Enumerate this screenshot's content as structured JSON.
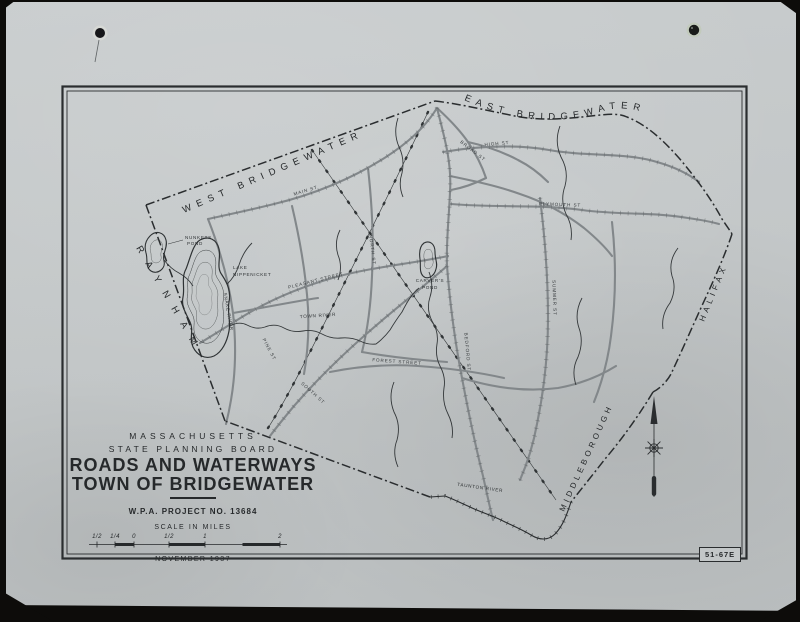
{
  "photo": {
    "plate_number": "51-67E"
  },
  "title_block": {
    "state": "MASSACHUSETTS",
    "agency": "STATE PLANNING BOARD",
    "title_line1": "ROADS AND WATERWAYS",
    "title_line2": "TOWN OF BRIDGEWATER",
    "project": "W.P.A. PROJECT NO. 13684",
    "scale_label": "SCALE IN MILES",
    "date": "NOVEMBER 1937"
  },
  "scale_bar": {
    "labels": [
      "1/2",
      "1/4",
      "0",
      "1/2",
      "1",
      "2"
    ]
  },
  "neighbors": {
    "west": "WEST BRIDGEWATER",
    "east": "EAST BRIDGEWATER",
    "southwest": "RAYNHAM",
    "northeast": "HALIFAX",
    "southeast": "MIDDLEBOROUGH"
  },
  "water_labels": {
    "nunkets_line1": "NUNKETS",
    "nunkets_line2": "POND",
    "nippenicket_line1": "LAKE",
    "nippenicket_line2": "NIPPENICKET",
    "carvers_line1": "CARVER'S",
    "carvers_line2": "POND",
    "town_river": "TOWN RIVER",
    "taunton_river": "TAUNTON RIVER",
    "snake_river": "SNAKE RIVER"
  },
  "street_labels": [
    {
      "text": "MAIN ST"
    },
    {
      "text": "HIGH ST"
    },
    {
      "text": "BROAD ST"
    },
    {
      "text": "PLYMOUTH ST"
    },
    {
      "text": "PLEASANT STREET"
    },
    {
      "text": "NORTH ST"
    },
    {
      "text": "PINE ST"
    },
    {
      "text": "FOREST STREET"
    },
    {
      "text": "SOUTH ST"
    },
    {
      "text": "BEDFORD ST"
    },
    {
      "text": "SUMMER ST"
    }
  ],
  "colors": {
    "sheet": "#c2c6c7",
    "ink": "#2a2d2f",
    "road": "#82878a",
    "backdrop": "#0d0c0a"
  }
}
